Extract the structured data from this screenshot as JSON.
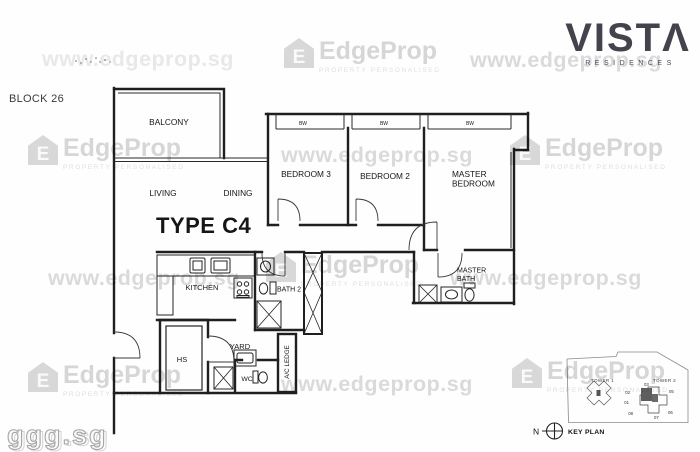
{
  "header": {
    "block_label": "BLOCK 26",
    "logo": {
      "name": "VISTA",
      "display": "VISTΛ",
      "sub": "RESIDENCES"
    }
  },
  "plan": {
    "type_label": "TYPE C4",
    "rooms": {
      "balcony": "BALCONY",
      "living": "LIVING",
      "dining": "DINING",
      "bedroom3": "BEDROOM 3",
      "bedroom2": "BEDROOM 2",
      "master_bedroom_line1": "MASTER",
      "master_bedroom_line2": "BEDROOM",
      "kitchen": "KITCHEN",
      "bath2": "BATH 2",
      "master_bath_line1": "MASTER",
      "master_bath_line2": "BATH",
      "hs": "HS",
      "yard": "YARD",
      "wc": "WC",
      "ac_ledge": "A/C LEDGE",
      "bay_window": "BW"
    }
  },
  "keyplan": {
    "label": "KEY PLAN",
    "north": "N",
    "tower1": "TOWER 1",
    "tower2": "TOWER 2",
    "units": {
      "u03": "03",
      "u02": "02",
      "u01": "01",
      "u08": "08",
      "u05": "05",
      "u06": "06",
      "u07": "07"
    }
  },
  "watermarks": {
    "site": "www.edgeprop.sg",
    "brand": "EdgeProp",
    "brand_sub": "PROPERTY PERSONALISED",
    "brand_icon_letter": "E",
    "corner": "ggg.sg"
  },
  "colors": {
    "logo": "#43434d",
    "plan_line": "#1f1f1f",
    "watermark_gray": "#d2d2d2"
  }
}
